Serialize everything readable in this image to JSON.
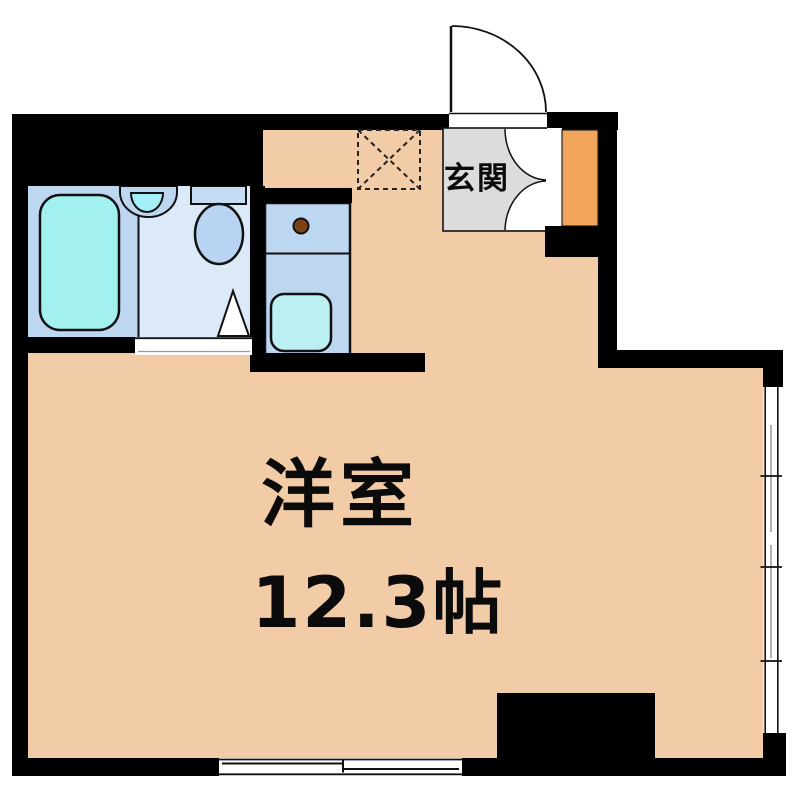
{
  "floorplan": {
    "entrance": {
      "label": "玄関"
    },
    "room": {
      "name": "洋室",
      "size": "12.3帖"
    },
    "fixtures": {
      "bathtub": "bathtub",
      "washbasin": "washbasin",
      "toilet": "toilet",
      "bathroom_door": "bathroom-door-swing",
      "kitchen_unit": "mini-kitchen-counter",
      "kitchen_sink": "kitchen-sink",
      "burner_knob": "burner-knob",
      "washer_space": "washing-machine-space",
      "entrance_door": "entrance-door-swing",
      "shoe_cabinet": "shoe-cabinet",
      "cabinet_doors": "double-door-swing",
      "window_bottom": "sliding-window",
      "window_right": "sliding-window",
      "pillar": "pillar"
    },
    "colors": {
      "floor": "#F2CBA7",
      "wall": "#000000",
      "outside": "#FFFFFF",
      "bath_floor": "#BED7F1",
      "washroom_floor": "#DCE9F8",
      "bathtub": "#A2F0F0",
      "basin_inner": "#A5EFF8",
      "basin_outer": "#BED7F1",
      "toilet_tank": "#C5DCF5",
      "toilet_bowl": "#B9D4F2",
      "kitchen_unit": "#BED7F1",
      "kitchen_sink": "#BCEFF2",
      "burner_knob": "#7B4418",
      "genkan_floor": "#DCDCDC",
      "shoe_cabinet": "#F2A55C",
      "line": "#111111",
      "sash_gray": "#999999"
    }
  }
}
